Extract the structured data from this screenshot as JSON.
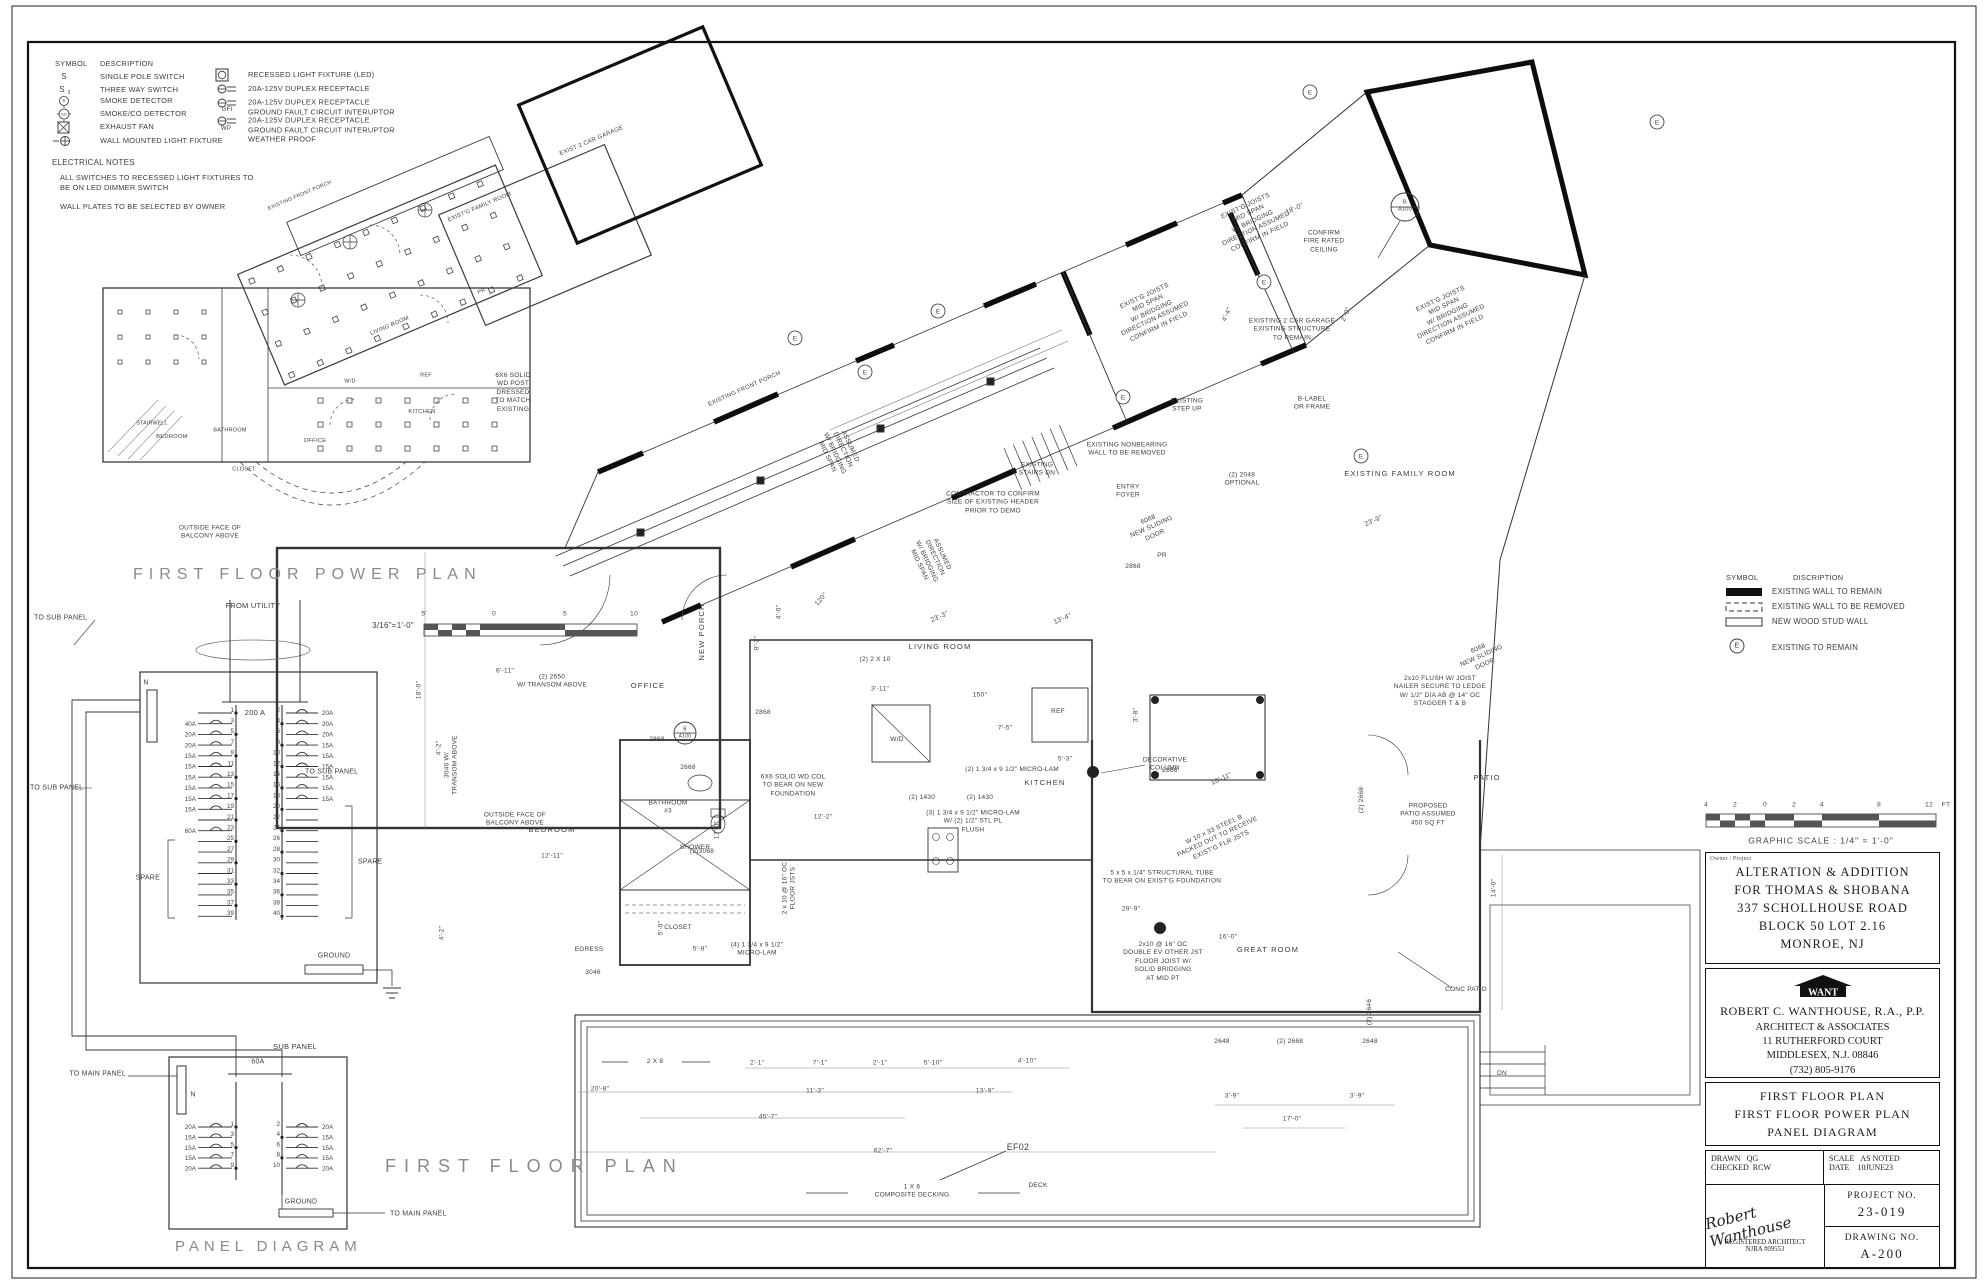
{
  "legend": {
    "header_symbol": "SYMBOL",
    "header_desc": "DESCRIPTION",
    "sym_s": "S",
    "sym_s3": "S",
    "sym_s3_sub": "3",
    "sym_smoke": "S",
    "sym_sd": "SD",
    "items_left": [
      "SINGLE POLE SWITCH",
      "THREE WAY SWITCH",
      "SMOKE DETECTOR",
      "SMOKE/CO DETECTOR",
      "EXHAUST FAN",
      "WALL MOUNTED LIGHT FIXTURE"
    ],
    "items_right": [
      "RECESSED LIGHT FIXTURE (LED)",
      "20A-125V DUPLEX RECEPTACLE",
      "20A-125V DUPLEX RECEPTACLE\nGROUND FAULT CIRCUIT INTERUPTOR",
      "20A-125V DUPLEX RECEPTACLE\nGROUND FAULT CIRCUIT INTERUPTOR\nWEATHER PROOF"
    ],
    "gfi": "GFI",
    "wp": "WP"
  },
  "notes": {
    "title": "ELECTRICAL NOTES",
    "body": "ALL SWITCHES TO RECESSED LIGHT FIXTURES TO\nBE ON LED DIMMER SWITCH\n\nWALL PLATES TO BE SELECTED BY OWNER"
  },
  "pp": {
    "title": "FIRST FLOOR POWER PLAN",
    "scale": "3/16\"=1'-0\"",
    "ticks": [
      "5'",
      "0",
      "5",
      "10"
    ],
    "rooms": {
      "living": "LIVING ROOM",
      "bedroom": "BEDROOM",
      "bathroom": "BATHROOM",
      "closet": "CLOSET",
      "office": "OFFICE",
      "kitchen": "KITCHEN",
      "ref": "REF",
      "wd": "W/D",
      "pr": "PR",
      "garage": "EXIST 2 CAR GARAGE",
      "family": "EXIST'G FAMILY ROOM",
      "front_porch": "EXISTING FRONT PORCH",
      "stairwell": "STAIRWELL"
    }
  },
  "fp": {
    "title": "FIRST FLOOR PLAN",
    "rooms": {
      "new_porch": "NEW PORCH",
      "bedroom": "BEDROOM",
      "bath3": "BATHROOM\n#3",
      "shower": "SHOWER",
      "closet": "CLOSET",
      "office": "OFFICE",
      "kitchen": "KITCHEN",
      "living": "LIVING ROOM",
      "great": "GREAT ROOM",
      "entry": "ENTRY\nFOYER",
      "pr": "PR",
      "family": "EXISTING FAMILY ROOM",
      "patio": "PATIO",
      "deck": "DECK",
      "wd": "W/D",
      "ref": "REF",
      "front_porch": "EXISTING FRONT PORCH",
      "egress": "EGRESS",
      "dn": "DN",
      "garage": "EXISTING 2 CAR GARAGE\nEXISTING STRUCTURE\nTO REMAIN"
    },
    "notes": {
      "post": "6X6 SOLID\nWD POST\nDRESSED\nTO MATCH\nEXISTING",
      "balcony": "OUTSIDE FACE OF\nBALCONY ABOVE",
      "two_2x10": "(2) 2 X 10",
      "micro2": "(2) 1 3/4 x 9 1/2\" MICRO-LAM",
      "micro3": "(3) 1 3/4 x 9 1/2\" MICRO-LAM\nW/ (2) 1/2\" STL PL\nFLUSH",
      "micro4": "(4) 1 3/4 x 9 1/2\"\nMICRO-LAM",
      "floor_jsts": "2 x 10 @ 16\" OC\nFLOOR JSTS",
      "steel": "W 10 x 33 STEEL B\nPACKED OUT TO RECEIVE\nEXIST'G FLR JSTS",
      "tube": "5 x 5 x 1/4\" STRUCTURAL TUBE\nTO BEAR ON EXIST'G FOUNDATION",
      "joist_double": "2x10 @ 16\" OC\nDOUBLE EV OTHER JST\nFLOOR JOIST W/\nSOLID BRIDGING\nAT MID PT",
      "col": "6X6 SOLID WD COL\nTO BEAR ON NEW\nFOUNDATION",
      "nailer": "2x10 FLUSH W/ JOIST\nNAILER SECURE TO LEDGE\nW/ 1/2\" DIA AB @ 14\" OC\nSTAGGER T & B",
      "deco": "DECORATIVE\nCOLUMN",
      "patio_prop": "PROPOSED\nPATIO ASSUMED\n450 SQ FT",
      "conc": "CONC PATIO",
      "contractor": "CONTRACTOR TO CONFIRM\nSIZE OF EXISTING HEADER\nPRIOR TO DEMO",
      "stairs_dn": "EXISTING\nSTAIRS DN",
      "nonbearing": "EXISTING NONBEARING\nWALL TO BE REMOVED",
      "step_up": "EXISTING\nSTEP UP",
      "fire": "CONFIRM\nFIRE RATED\nCEILING",
      "blabel": "B-LABEL\nOR FRAME",
      "opt": "(2) 2048\nOPTIONAL",
      "exist_joists": "EXIST'G JOISTS\nMID SPAN\nW/ BRIDGING\nDIRECTION ASSUMED\nCONFIRM IN FIELD",
      "assumed": "ASSUMED\nDIRECTION\nW/ BRIDGING\nMID SPAN",
      "decking": "1 X 6\nCOMPOSITE DECKING",
      "two_2x8": "2 X 8",
      "ef": "EF02",
      "callout": "B\nA100"
    },
    "dims": [
      "6'-11\"",
      "12'-11\"",
      "17'-0\"",
      "18'-0\"",
      "4'-2\"",
      "4'-2\"",
      "3'-11\"",
      "7'-5\"",
      "5'-3\"",
      "16'-0\"",
      "29'-9\"",
      "14'-0\"",
      "12'-2\"",
      "5'-8\"",
      "5'-0\"",
      "3'-8\"",
      "23'-3\"",
      "13'-4\"",
      "23'-9\"",
      "18'-0\"",
      "18'-11\"",
      "20'-8\"",
      "45'-7\"",
      "62'-7\"",
      "11'-3\"",
      "13'-9\"",
      "2'-1\"",
      "7'-1\"",
      "2'-1\"",
      "5'-10\"",
      "4'-10\"",
      "3'-9\"",
      "3'-9\"",
      "17'-0\"",
      "150°",
      "120°",
      "8'-2\"",
      "4'-0\"",
      "4'-4\"",
      "2'-0\""
    ],
    "tags": [
      "(2) 2650\nW/ TRANSOM ABOVE",
      "3046 W/\nTRANSOM ABOVE",
      "2868",
      "2868",
      "2868",
      "2668",
      "(2)3068",
      "(2) 1430",
      "(2) 1430",
      "2648",
      "(2) 2668",
      "2648",
      "(2) 2668",
      "(2) 2646",
      "3046",
      "6068\nNEW SLIDING\nDOOR",
      "6068\nNEW SLIDING\nDOOR",
      "2868"
    ]
  },
  "panel": {
    "from_utility": "FROM UTILITY",
    "main_breaker": "200 A",
    "neutral": "N",
    "ground": "GROUND",
    "spare": "SPARE",
    "to_sub_panel": "TO SUB PANEL",
    "to_main_panel": "TO MAIN PANEL",
    "sub_panel": "SUB PANEL",
    "sub_breaker": "60A",
    "diagram_title": "PANEL DIAGRAM",
    "main_rows": [
      {
        "l": "",
        "n1": "1",
        "n2": "2",
        "r": "20A"
      },
      {
        "l": "40A",
        "n1": "3",
        "n2": "4",
        "r": "20A"
      },
      {
        "l": "20A",
        "n1": "5",
        "n2": "6",
        "r": "20A"
      },
      {
        "l": "20A",
        "n1": "7",
        "n2": "8",
        "r": "15A"
      },
      {
        "l": "15A",
        "n1": "9",
        "n2": "10",
        "r": "15A"
      },
      {
        "l": "15A",
        "n1": "11",
        "n2": "12",
        "r": "15A"
      },
      {
        "l": "15A",
        "n1": "13",
        "n2": "14",
        "r": "15A"
      },
      {
        "l": "15A",
        "n1": "15",
        "n2": "16",
        "r": "15A"
      },
      {
        "l": "15A",
        "n1": "17",
        "n2": "18",
        "r": "15A"
      },
      {
        "l": "15A",
        "n1": "19",
        "n2": "20",
        "r": ""
      },
      {
        "l": "",
        "n1": "21",
        "n2": "22",
        "r": ""
      },
      {
        "l": "60A",
        "n1": "23",
        "n2": "24",
        "r": ""
      },
      {
        "l": "",
        "n1": "25",
        "n2": "26",
        "r": ""
      },
      {
        "l": "",
        "n1": "27",
        "n2": "28",
        "r": ""
      },
      {
        "l": "",
        "n1": "29",
        "n2": "30",
        "r": ""
      },
      {
        "l": "",
        "n1": "31",
        "n2": "32",
        "r": ""
      },
      {
        "l": "",
        "n1": "33",
        "n2": "34",
        "r": ""
      },
      {
        "l": "",
        "n1": "35",
        "n2": "36",
        "r": ""
      },
      {
        "l": "",
        "n1": "37",
        "n2": "38",
        "r": ""
      },
      {
        "l": "",
        "n1": "39",
        "n2": "40",
        "r": ""
      }
    ],
    "sub_rows": [
      {
        "l": "20A",
        "n1": "1",
        "n2": "2",
        "r": "20A"
      },
      {
        "l": "15A",
        "n1": "3",
        "n2": "4",
        "r": "15A"
      },
      {
        "l": "15A",
        "n1": "5",
        "n2": "6",
        "r": "15A"
      },
      {
        "l": "15A",
        "n1": "7",
        "n2": "8",
        "r": "15A"
      },
      {
        "l": "20A",
        "n1": "9",
        "n2": "10",
        "r": "20A"
      }
    ]
  },
  "walls": {
    "header_symbol": "SYMBOL",
    "header_desc": "DISCRIPTION",
    "remain": "EXISTING WALL TO REMAIN",
    "removed": "EXISTING WALL TO BE REMOVED",
    "new_wall": "NEW WOOD STUD WALL",
    "e_sym": "E",
    "e_desc": "EXISTING TO REMAIN"
  },
  "gscale": {
    "ticks": [
      "4",
      "2",
      "0",
      "2",
      "4",
      "8",
      "12"
    ],
    "unit": "FT",
    "label": "GRAPHIC SCALE : 1/4\" = 1'-0\""
  },
  "tb": {
    "owner_label": "Owner / Project",
    "project": "ALTERATION & ADDITION\nFOR THOMAS & SHOBANA\n337 SCHOLLHOUSE ROAD\nBLOCK 50   LOT 2.16\nMONROE,  NJ",
    "logo": "WANT",
    "architect": "ROBERT C. WANTHOUSE, R.A., P.P.",
    "arch_addr": "ARCHITECT & ASSOCIATES\n11 RUTHERFORD COURT\nMIDDLESEX, N.J. 08846\n(732) 805-9176",
    "sheet_title": "FIRST FLOOR PLAN\nFIRST FLOOR POWER PLAN\nPANEL DIAGRAM",
    "drawn_label": "DRAWN",
    "drawn": "QG",
    "checked_label": "CHECKED",
    "checked": "RCW",
    "scale_label": "SCALE",
    "scale": "AS NOTED",
    "date_label": "DATE",
    "date": "10JUNE23",
    "signature": "Robert Wanthouse",
    "registered": "REGISTERED ARCHITECT\nNJRA #09553",
    "project_no_label": "PROJECT NO.",
    "project_no": "23-019",
    "drawing_no_label": "DRAWING NO.",
    "drawing_no": "A-200"
  }
}
